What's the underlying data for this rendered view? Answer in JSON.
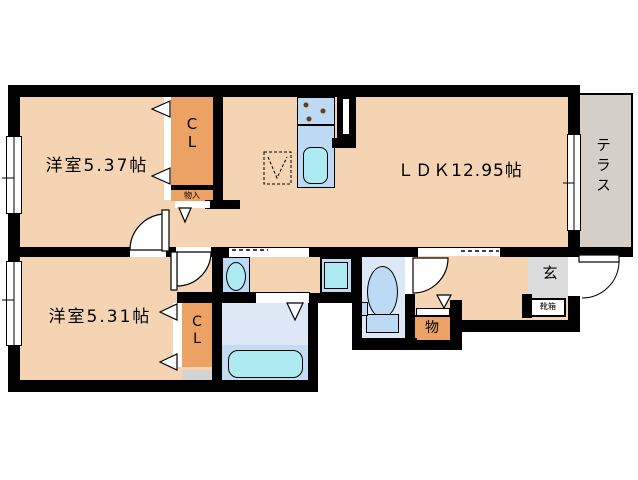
{
  "plan": {
    "title": "1LDK+2洋室 floor plan",
    "rooms": {
      "bedroom1": {
        "label": "洋室5.37帖",
        "area_jo": 5.37
      },
      "ldk": {
        "label": "ＬＤＫ12.95帖",
        "area_jo": 12.95
      },
      "bedroom2": {
        "label": "洋室5.31帖",
        "area_jo": 5.31
      },
      "terrace": {
        "label": "テラス"
      },
      "closet_upper": {
        "label": "C\nL"
      },
      "closet_lower": {
        "label": "C\nL"
      },
      "storage_upper": {
        "label": "物入"
      },
      "storage_hall": {
        "label": "物"
      },
      "entrance": {
        "label": "玄"
      },
      "shoe_cabinet": {
        "label": "靴箱"
      }
    },
    "colors": {
      "wall": "#000000",
      "floor": "#f4d4b2",
      "closet_orange": "#eba264",
      "terrace_gray": "#d6cfc7",
      "entrance_gray": "#dcdcdc",
      "bathroom_blue": "#dce8f6",
      "fixture_blue": "#bcdaf3",
      "water_cyan": "#aeeaf2"
    }
  }
}
